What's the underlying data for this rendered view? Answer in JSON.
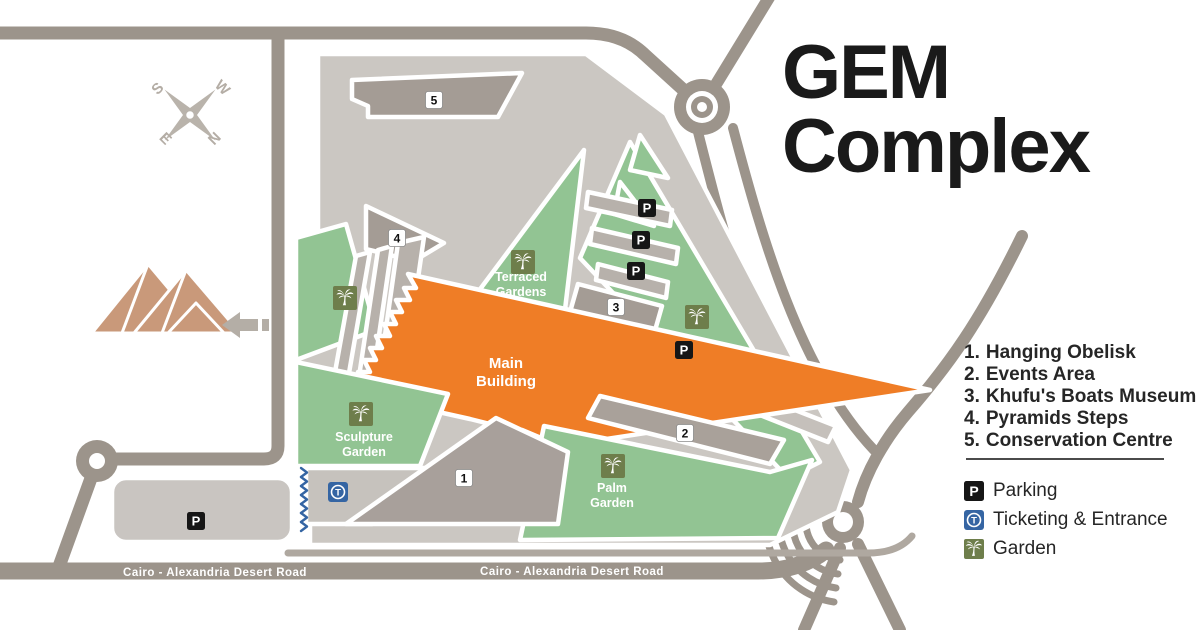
{
  "title": {
    "line1": "GEM",
    "line2": "Complex"
  },
  "compass": {
    "s": "S",
    "w": "W",
    "e": "E",
    "n": "N"
  },
  "numbered_list": {
    "items": [
      {
        "num": "1.",
        "label": "Hanging Obelisk"
      },
      {
        "num": "2.",
        "label": "Events Area"
      },
      {
        "num": "3.",
        "label": "Khufu's Boats Museum"
      },
      {
        "num": "4.",
        "label": "Pyramids Steps"
      },
      {
        "num": "5.",
        "label": "Conservation Centre"
      }
    ]
  },
  "key": {
    "parking": {
      "symbol": "P",
      "label": "Parking"
    },
    "ticketing": {
      "symbol": "T",
      "label": "Ticketing & Entrance"
    },
    "garden": {
      "label": "Garden"
    }
  },
  "roads": {
    "cairo_alexandria_1": "Cairo - Alexandria Desert Road",
    "cairo_alexandria_2": "Cairo - Alexandria Desert Road",
    "ring_road": "Ring Road"
  },
  "map": {
    "areas": {
      "main_building": {
        "line1": "Main",
        "line2": "Building"
      },
      "terraced_gardens": {
        "line1": "Terraced",
        "line2": "Gardens"
      },
      "sculpture_garden": {
        "line1": "Sculpture",
        "line2": "Garden"
      },
      "palm_garden": {
        "line1": "Palm",
        "line2": "Garden"
      }
    },
    "markers": {
      "m1": "1",
      "m2": "2",
      "m3": "3",
      "m4": "4",
      "m5": "5"
    },
    "parking_symbol": "P",
    "ticketing_symbol": "T"
  },
  "colors": {
    "road_gray": "#9C948B",
    "plot_gray": "#CBC7C2",
    "building_gray": "#A49C95",
    "strip_gray": "#B7B1AB",
    "garden_green": "#92C493",
    "palm_icon_olive": "#6E7E4B",
    "main_building_orange": "#EF7D26",
    "ticketing_blue": "#3565A3",
    "pyramid_tan": "#C9997A",
    "text_black": "#1A1A1A"
  }
}
